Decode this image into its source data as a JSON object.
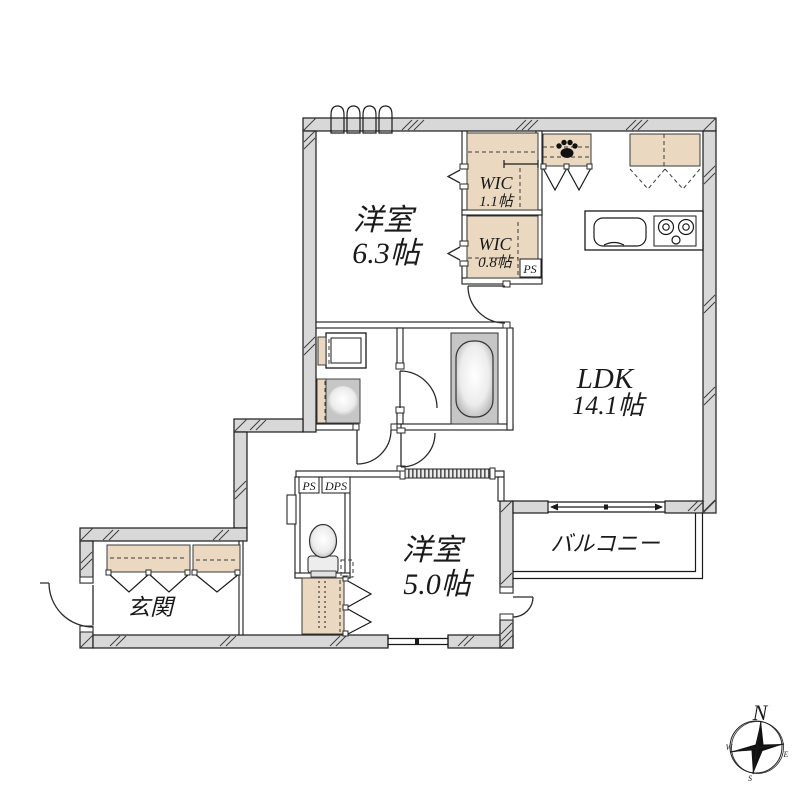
{
  "rooms": {
    "bedroom_a": {
      "name": "洋室",
      "area": "6.3帖"
    },
    "bedroom_b": {
      "name": "洋室",
      "area": "5.0帖"
    },
    "ldk": {
      "name": "LDK",
      "area": "14.1帖"
    },
    "wic_large": {
      "name": "WIC",
      "area": "1.1帖"
    },
    "wic_small": {
      "name": "WIC",
      "area": "0.8帖"
    },
    "balcony": {
      "name": "バルコニー"
    },
    "entrance": {
      "name": "玄関"
    }
  },
  "shafts": {
    "ps_wic": "PS",
    "ps_hall": "PS",
    "dps_hall": "DPS"
  },
  "compass": {
    "north": "N",
    "east": "E",
    "south": "S",
    "west": "W"
  },
  "colors": {
    "wall_fill": "#d8d8d8",
    "closet_fill": "#ead9c0",
    "fixture_gray": "#c6c6c6",
    "outline": "#1a1a1a",
    "background": "#ffffff"
  }
}
